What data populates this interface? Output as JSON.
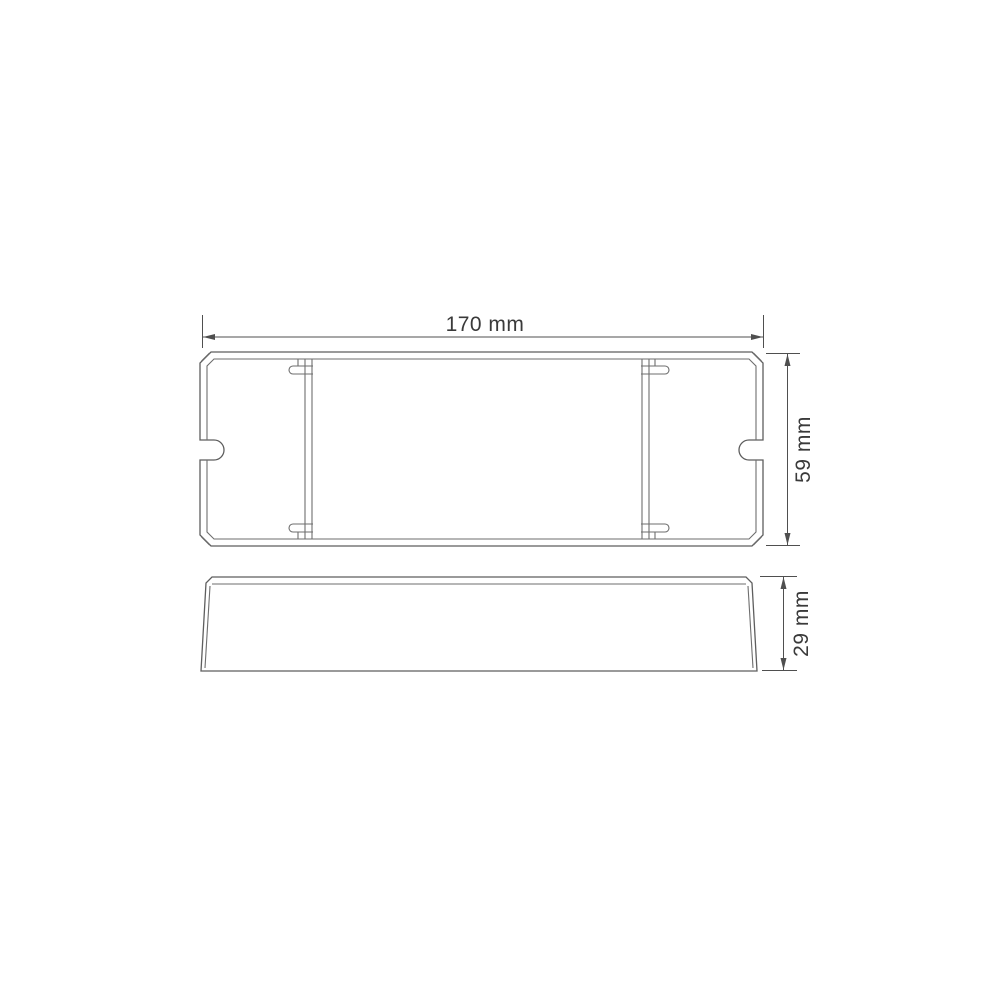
{
  "page": {
    "background": "#ffffff"
  },
  "drawing": {
    "type": "technical-dimension-drawing",
    "views": [
      {
        "id": "top-view"
      },
      {
        "id": "side-view"
      }
    ],
    "dimensions": {
      "width": {
        "label": "170 mm"
      },
      "height": {
        "label": "59 mm"
      },
      "depth": {
        "label": "29 mm"
      }
    },
    "colors": {
      "outline": "#5e5e5e",
      "dimension_line": "#4f4f4f",
      "text": "#3a3a3a",
      "background": "#ffffff"
    }
  }
}
